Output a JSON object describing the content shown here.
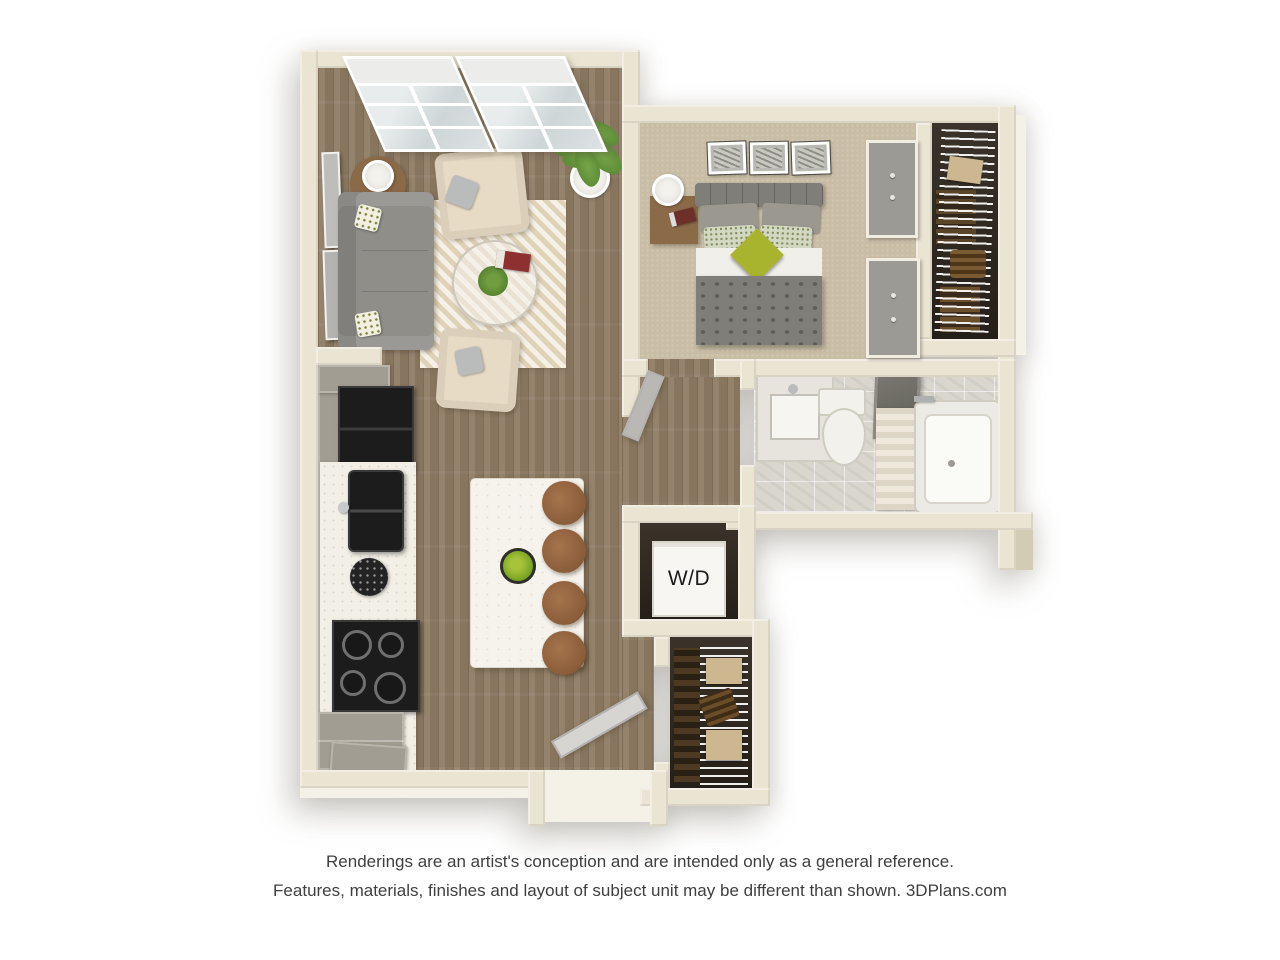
{
  "labels": {
    "washer_dryer": "W/D"
  },
  "footer": {
    "line1": "Renderings are an artist's conception and are intended only as a general reference.",
    "line2": "Features, materials, finishes and layout of subject unit may be different than shown. 3DPlans.com"
  },
  "palette": {
    "background": "#ffffff",
    "wall": "#eae4d2",
    "wall_shade": "#d2ccb6",
    "wall_bright": "#f4f1e6",
    "wood_floor": "#8e7b63",
    "carpet": "#c9bda6",
    "tile": "#d9d6ce",
    "rug": "#ebe1ca",
    "closet_dark": "#322b22",
    "island_white": "#f5f3ec",
    "cabinet_gray": "#a19d92",
    "counter_white": "#f2efe7",
    "appliance_black": "#1c1c1c",
    "sofa_gray": "#8f8e89",
    "bed_gray": "#807e79",
    "accent_green": "#a9b42e",
    "plant_green": "#55832f",
    "stool_brown": "#8a5c39",
    "chair_beige": "#e7dbc6",
    "wood_furniture": "#8b6a48",
    "fixture_white": "#f2f1ec",
    "door_gray": "#d6d5d1",
    "text_gray": "#3f3f3f"
  }
}
